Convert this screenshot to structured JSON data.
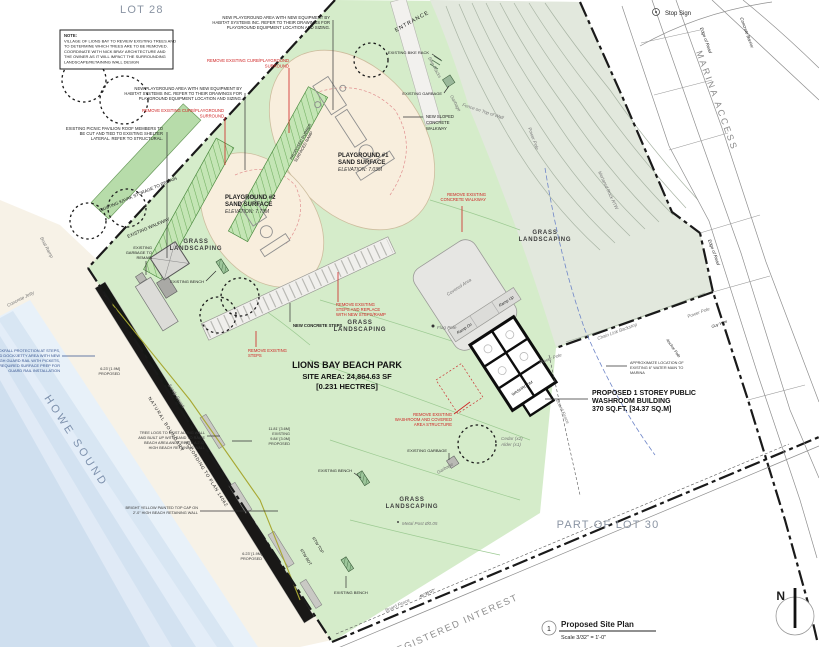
{
  "areas": {
    "lot28": "LOT 28",
    "lot30": "PART OF LOT 30",
    "howe_sound": "HOWE SOUND",
    "registered_interest": "REGISTERED INTEREST",
    "marina_access": "MARINA ACCESS",
    "entrance": "ENTRANCE"
  },
  "site": {
    "name": "LIONS BAY BEACH PARK",
    "area": "SITE AREA: 24,864.63 SF",
    "hectares": "[0.231 HECTRES]"
  },
  "playground1": [
    "PLAYGROUND #1",
    "SAND SURFACE",
    "ELEVATION: 7.03M"
  ],
  "playground2": [
    "PLAYGROUND #2",
    "SAND SURFACE",
    "ELEVATION: 7.73M"
  ],
  "ramp_band": [
    "PROPOSED RUBBER",
    "SURFACED RAMP"
  ],
  "washroom_callout": [
    "PROPOSED 1 STOREY PUBLIC",
    "WASHROOM BUILDING",
    "370 SQ.FT. [34.37 SQ.M]"
  ],
  "note_box": [
    "NOTE:",
    "VILLAGE OF LIONS BAY TO REVIEW EXISTING TREES AND",
    "TO DETERMINE WHICH TREES ARE TO BE REMOVED.",
    "COORDINATE WITH NICK BRAY ARCHITECTURE AND",
    "THE OWNER AS IT WILL IMPACT THE SURROUNDING",
    "LANDSCAPE/RETAINING WALL DESIGN"
  ],
  "playground_note": [
    "NEW PLAYGROUND AREA WITH NEW EQUIPMENT BY",
    "HABITAT SYSTEMS INC. REFER TO THEIR DRAWINGS FOR",
    "PLAYGROUND EQUIPMENT LOCATION AND SIZING."
  ],
  "pavilion_note": [
    "EXISTING PICNIC PAVILION ROOF MEMBERS TO",
    "BE CUT AND TIED TO EXISTING SHELTER",
    "LATERAL. REFER TO STRUCTURAL."
  ],
  "red_notes": {
    "curb": [
      "REMOVE EXISTING CURB/PLAYGROUND",
      "SURROUND"
    ],
    "steps_replace": [
      "REMOVE EXISTING",
      "STEPS AND REPLACE",
      "WITH NEW STEPS/RAMP"
    ],
    "steps": [
      "REMOVE EXISTING",
      "STEPS"
    ],
    "washroom": [
      "REMOVE EXISTING",
      "WASHROOM AND COVERED",
      "AREA STRUCTURE"
    ],
    "walkway": [
      "REMOVE EXISTING",
      "CONCRETE WALKWAY"
    ]
  },
  "notes": {
    "rockfall": [
      "ADD ROCKFALL PROTECTION AT STEPS,",
      "RAMP AND DOCK/JETTY AREA WITH NEW",
      "42\" HIGH GUARD RAIL WITH PICKETS,",
      "INCLUDING REQUIRED SURFACE PREP FOR",
      "GUARD RAIL INSTALLATION"
    ],
    "tree_logs": [
      "TREE LOGS TO EXIST ALONG WALL",
      "AND BUILT UP WITH SAND TO RAISE",
      "BEACH AREA AND CREATE A 2'-0\"",
      "HIGH BEACH RETAINING WALL"
    ],
    "yellow_cap": [
      "BRIGHT YELLOW PAINTED TOP CAP ON",
      "2'-0\" HIGH BEACH RETAINING WALL"
    ],
    "water_main": [
      "APPROXIMATE LOCATION OF",
      "EXISTING 6\" WATER MAIN TO",
      "MARINA"
    ],
    "sloped_walkway": [
      "NEW SLOPED",
      "CONCRETE",
      "WALKWAY"
    ],
    "new_concrete_steps": "NEW CONCRETE STEPS",
    "garbage_remain": [
      "EXISTING",
      "GARBAGE TO",
      "REMAIN"
    ]
  },
  "dims": {
    "d1": [
      "11.81' [3.6M]",
      "EXISTING",
      "9.84' [3.0M]",
      "PROPOSED"
    ],
    "d2": [
      "6.23' [1.9M]",
      "PROPOSED"
    ]
  },
  "labels": {
    "stop_sign": "Stop Sign",
    "concrete_jetty": "Concrete Jetty",
    "boat_ramp": "Boat Ramp",
    "sandy_beach": "Sandy Beach",
    "natural_boundary": "NATURAL BOUNDARY",
    "according_plan": "ACCORDING TO PLAN 14062",
    "rtw_top": "RTW TOP",
    "rtw_bot": "RTW BOT",
    "board_fence": "Board Fence",
    "bearing": "46°35'07\"",
    "existing_walkway": "EXISTING WALKWAY",
    "kayak_storage": "EXISTING KAYAK STORAGE TO REMAIN",
    "grass1": "GRASS",
    "grass2": "LANDSCAPING",
    "metal_post": "Metal Post Ø0.05",
    "cedar": "Cedar (x2)",
    "alder": "Alder (x1)",
    "garbage": "Garbage",
    "bike_racks": "Bike Racks",
    "flag_pole": "Flag Pole",
    "covered_area": "Covered Area",
    "ramp_up": "Ramp Up",
    "ramp_dn": "Ramp Dn",
    "washroom_room": "WASHROOM",
    "power_pole": "Power Pole",
    "guy_wire": "Guy Wire",
    "anchor_pole": "Anchor Pole",
    "chain_link": "Chain Link Backstop",
    "edge_of_road": "Edge of Road",
    "concrete_barrier": "Concrete Barrier",
    "mortared_rtw": "Mortared Rock RTW",
    "fence_wall": "Fence on Top of Wall",
    "existing_bench": "EXISTING BENCH",
    "existing_garbage": "EXISTING GARBAGE",
    "existing_bike_rack": "EXISTING BIKE RACK"
  },
  "titleblock": {
    "num": "1",
    "title": "Proposed Site Plan",
    "scale": "Scale 3/32\" = 1'-0\""
  },
  "north": {
    "letter": "N"
  }
}
